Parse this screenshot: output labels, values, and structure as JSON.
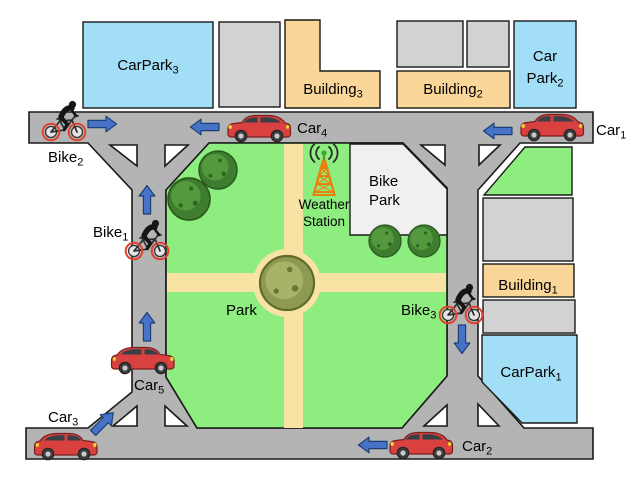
{
  "scene": {
    "description": "city block diagram with park, roads, car parks, buildings, weather station, cars and bikes"
  },
  "colors": {
    "road": "#b4b4b4",
    "outline": "#1a1a1a",
    "block_gray": "#d2d2d2",
    "bike_park_gray": "#f0f0f0",
    "carpark_blue": "#a2def5",
    "building_orange": "#fad699",
    "park_green": "#8dee7f",
    "path_tan": "#f9e3a4",
    "arrow_blue": "#4673c8",
    "arrow_outline": "#1c3f77",
    "car_red": "#d94040",
    "wheel_ring_red": "#e04232",
    "tower_orange": "#e8820e"
  },
  "areas": {
    "carparks": [
      {
        "base": "CarPark",
        "sub": "1"
      },
      {
        "line1": "Car",
        "base": "Park",
        "sub": "2"
      },
      {
        "base": "CarPark",
        "sub": "3"
      }
    ],
    "buildings": [
      {
        "base": "Building",
        "sub": "1"
      },
      {
        "base": "Building",
        "sub": "2"
      },
      {
        "base": "Building",
        "sub": "3"
      }
    ],
    "park_label": "Park",
    "bike_park": {
      "line1": "Bike",
      "line2": "Park"
    },
    "weather_station": {
      "line1": "Weather",
      "line2": "Station"
    }
  },
  "vehicles": {
    "cars": [
      {
        "base": "Car",
        "sub": "1"
      },
      {
        "base": "Car",
        "sub": "2"
      },
      {
        "base": "Car",
        "sub": "3"
      },
      {
        "base": "Car",
        "sub": "4"
      },
      {
        "base": "Car",
        "sub": "5"
      }
    ],
    "bikes": [
      {
        "base": "Bike",
        "sub": "1"
      },
      {
        "base": "Bike",
        "sub": "2"
      },
      {
        "base": "Bike",
        "sub": "3"
      }
    ]
  },
  "flow_arrows": [
    {
      "near": "Bike2",
      "direction": "right"
    },
    {
      "near": "Car4",
      "direction": "left"
    },
    {
      "near": "Car1",
      "direction": "left"
    },
    {
      "near": "Bike1",
      "direction": "up"
    },
    {
      "near": "Car5",
      "direction": "up"
    },
    {
      "near": "Car3",
      "direction": "up-right"
    },
    {
      "near": "Car2",
      "direction": "left"
    },
    {
      "near": "Bike3",
      "direction": "down"
    }
  ]
}
